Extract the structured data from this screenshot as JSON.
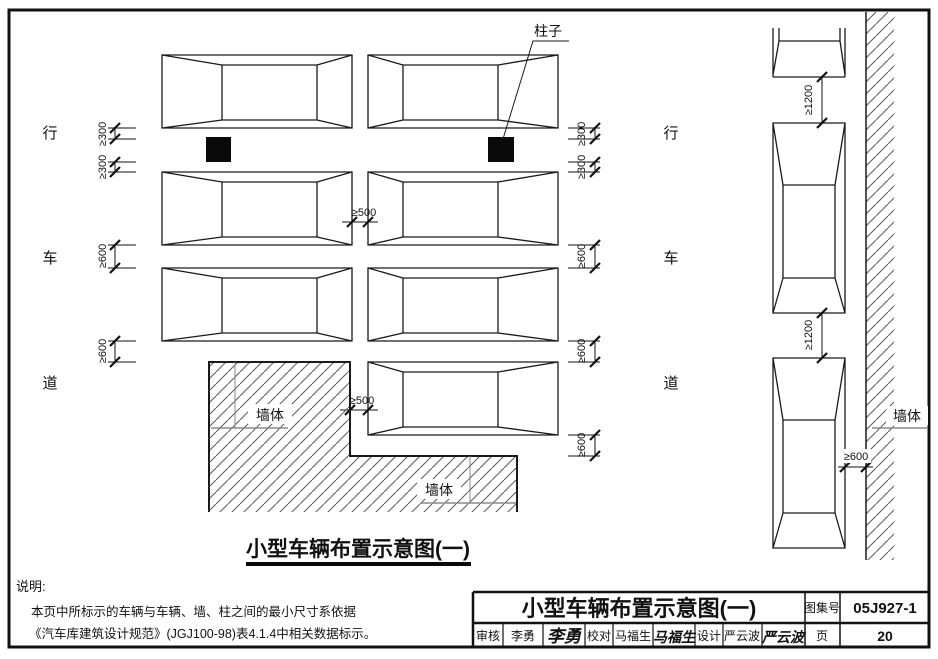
{
  "page": {
    "diagram_title": "小型车辆布置示意图(一)",
    "notes": {
      "heading": "说明:",
      "line1": "本页中所标示的车辆与车辆、墙、柱之间的最小尺寸系依据",
      "line2": "《汽车库建筑设计规范》(JGJ100-98)表4.1.4中相关数据标示。"
    }
  },
  "labels": {
    "column": "柱子",
    "wall": "墙体",
    "lane_left": [
      "行",
      "车",
      "道"
    ],
    "lane_right": [
      "行",
      "车",
      "道"
    ]
  },
  "dims": {
    "d300": "≥300",
    "d500": "≥500",
    "d600": "≥600",
    "d1200": "≥1200"
  },
  "titleblock": {
    "title": "小型车辆布置示意图(一)",
    "atlas_label": "图集号",
    "atlas_no": "05J927-1",
    "review_label": "审核",
    "review_name": "李勇",
    "review_sig": "李勇",
    "proof_label": "校对",
    "proof_name": "马福生",
    "proof_sig": "马福生",
    "design_label": "设计",
    "design_name": "严云波",
    "design_sig": "严云波",
    "page_label": "页",
    "page_no": "20"
  },
  "colors": {
    "line": "#1a1a1a",
    "leader": "#8a8a8a",
    "hatch": "#5a5a5a"
  }
}
